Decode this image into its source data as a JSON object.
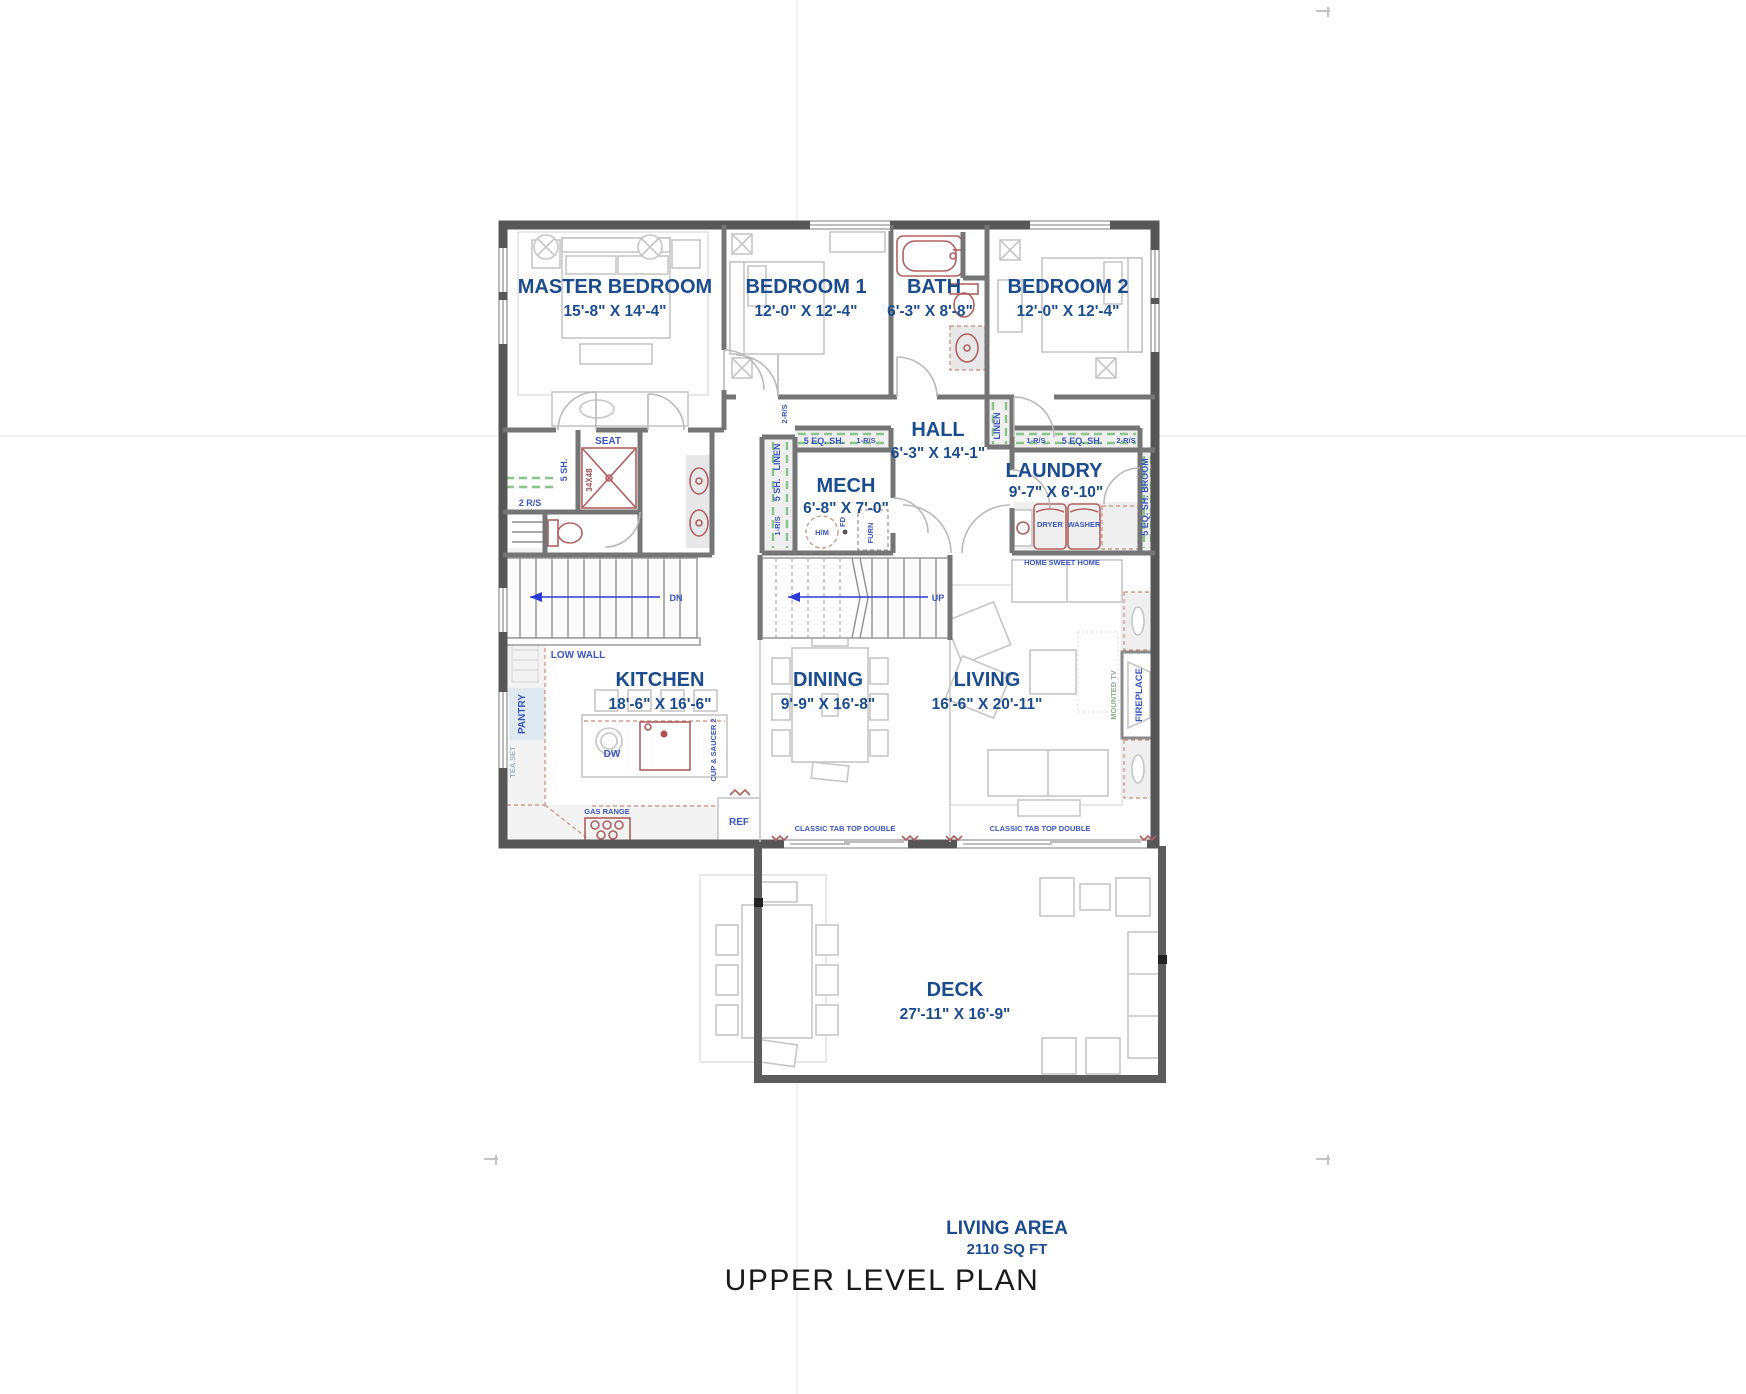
{
  "rooms": [
    {
      "name": "MASTER BEDROOM",
      "dims": "15'-8\" X 14'-4\""
    },
    {
      "name": "BEDROOM 1",
      "dims": "12'-0\" X 12'-4\""
    },
    {
      "name": "BATH",
      "dims": "6'-3\" X 8'-8\""
    },
    {
      "name": "BEDROOM 2",
      "dims": "12'-0\" X 12'-4\""
    },
    {
      "name": "HALL",
      "dims": "6'-3\" X 14'-1\""
    },
    {
      "name": "MECH",
      "dims": "6'-8\" X 7'-0\""
    },
    {
      "name": "LAUNDRY",
      "dims": "9'-7\" X 6'-10\""
    },
    {
      "name": "KITCHEN",
      "dims": "18'-6\" X 16'-6\""
    },
    {
      "name": "DINING",
      "dims": "9'-9\" X 16'-8\""
    },
    {
      "name": "LIVING",
      "dims": "16'-6\" X 20'-11\""
    },
    {
      "name": "DECK",
      "dims": "27'-11\" X 16'-9\""
    }
  ],
  "small": {
    "seat": "SEAT",
    "shower_size": "34X48",
    "sh5": "5 SH.",
    "rs2": "2 R/S",
    "rs2v": "2-R/S",
    "rs1": "1-R/S",
    "eq5": "5 EQ. SH.",
    "broom": "5 EQ. SH. BROOM",
    "linen": "LINEN",
    "low_wall": "LOW WALL",
    "pantry": "PANTRY",
    "tea_set": "TEA SET",
    "dw": "DW",
    "cup": "CUP & SAUCER 2",
    "gas": "GAS RANGE",
    "ref": "REF",
    "tab": "CLASSIC TAB TOP DOUBLE",
    "dryer": "DRYER",
    "washer": "WASHER",
    "hsh": "HOME SWEET HOME",
    "fire": "FIREPLACE",
    "tv": "MOUNTED TV",
    "hm": "H/M",
    "fd": "FD",
    "furn": "FURN",
    "dn": "DN",
    "up": "UP"
  },
  "footer": {
    "living_area": "LIVING AREA",
    "sqft": "2110 SQ FT",
    "title": "UPPER LEVEL PLAN"
  },
  "colors": {
    "room_label": "#1b4c8e",
    "small_label": "#3a56bd",
    "exterior_wall": "#575757",
    "interior_wall": "#757575",
    "fixture_red": "#b06060",
    "shelf_green": "#8bc48b",
    "stair_arrow": "#2a3bd6",
    "title_text": "#1a1a1a"
  }
}
